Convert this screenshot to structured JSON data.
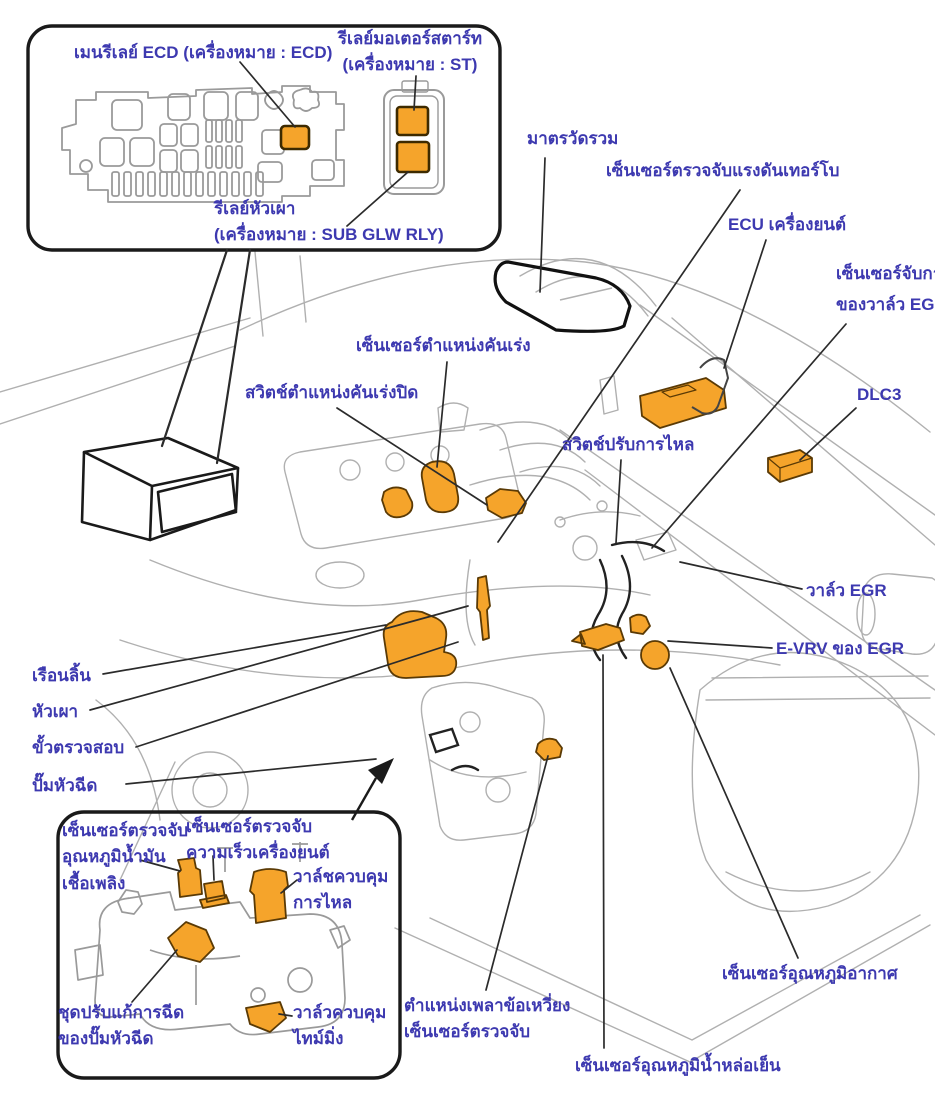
{
  "title": "ECD component location diagram (diesel engine)",
  "colors": {
    "label_text": "#3d39b0",
    "highlight_orange": "#f5a42b",
    "highlight_stroke": "#5a3a05",
    "art_gray": "#b0b0b0",
    "art_gray_dark": "#9a9a9a",
    "ink": "#1a1a1a",
    "background": "#ffffff"
  },
  "relay_inset": {
    "main_relay_label": "เมนรีเลย์ ECD (เครื่องหมาย : ECD)",
    "starter_relay_label": "รีเลย์มอเตอร์สตาร์ท\n(เครื่องหมาย : ST)",
    "glow_relay_label": "รีเลย์หัวเผา\n(เครื่องหมาย : SUB GLW RLY)"
  },
  "engine_labels": {
    "combination_meter": "มาตรวัดรวม",
    "turbo_pressure_sensor": "เซ็นเซอร์ตรวจจับแรงดันเทอร์โบ",
    "engine_ecu": "ECU เครื่องยนต์",
    "egr_valve_position_sensor": "เซ็นเซอร์จับการ\nของวาล์ว EGR",
    "dlc3": "DLC3",
    "accelerator_position_sensor": "เซ็นเซอร์ตำแหน่งคันเร่ง",
    "closed_throttle_switch": "สวิตช์ตำแหน่งคันเร่งปิด",
    "flow_adjusting_switch": "สวิตช์ปรับการไหล",
    "egr_valve": "วาล์ว EGR",
    "evrv_of_egr": "E-VRV ของ EGR",
    "throttle_body": "เรือนลิ้น",
    "glow_plug": "หัวเผา",
    "check_connector": "ขั้วตรวจสอบ",
    "injection_pump": "ปั๊มหัวฉีด",
    "crank_position_sensor": "ตำแหน่งเพลาข้อเหวี่ยง\nเซ็นเซอร์ตรวจจับ",
    "coolant_temp_sensor": "เซ็นเซอร์อุณหภูมิน้ำหล่อเย็น",
    "air_temp_sensor": "เซ็นเซอร์อุณหภูมิอากาศ"
  },
  "pump_inset": {
    "fuel_temp_sensor": "เซ็นเซอร์ตรวจจับ\nอุณหภูมิน้ำมัน\nเชื้อเพลิง",
    "engine_speed_sensor": "เซ็นเซอร์ตรวจจับ\nความเร็วเครื่องยนต์",
    "flow_control_valve": "วาล์ชควบคุม\nการไหล",
    "injection_correction_unit": "ชุดปรับแก้การฉีด\nของปั๊มหัวฉีด",
    "timing_control_valve": "วาล์วควบคุม\nไทม์มิ่ง"
  }
}
